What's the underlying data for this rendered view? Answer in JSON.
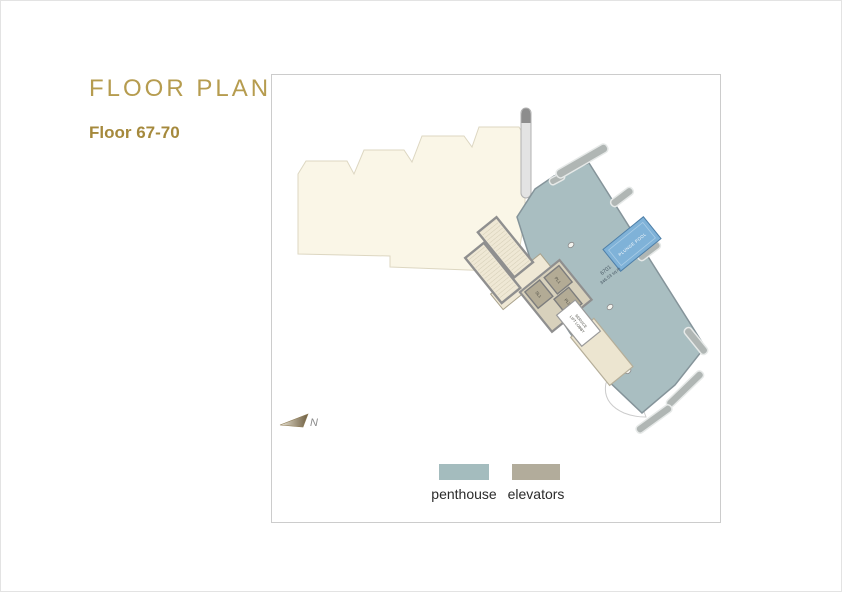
{
  "header": {
    "title": "FLOOR PLAN",
    "subtitle": "Floor 67-70"
  },
  "plan": {
    "unit": {
      "number": "6701",
      "area": "346.53 sq.m"
    },
    "pool_label": "PLUNGE POOL",
    "lifts": {
      "pl1": "PL1",
      "pl2": "PL2",
      "sl1": "SL1"
    },
    "service_lobby": {
      "line1": "SERVICE",
      "line2": "LIFT LOBBY"
    },
    "north_label": "N"
  },
  "legend": {
    "items": [
      {
        "label": "penthouse",
        "color": "#a4bcbe"
      },
      {
        "label": "elevators",
        "color": "#b2ac9b"
      }
    ]
  },
  "colors": {
    "accent_gold": "#b69c4f",
    "penthouse_fill": "#a9bec1",
    "penthouse_stroke": "#85949a",
    "elevator_fill": "#b3ab95",
    "stair_fill": "#efe8d5",
    "cream_fill": "#faf6e7",
    "cream_stroke": "#ddd7c2",
    "pool_fill": "#7fb2d8",
    "pool_stroke": "#4e7fa8"
  }
}
